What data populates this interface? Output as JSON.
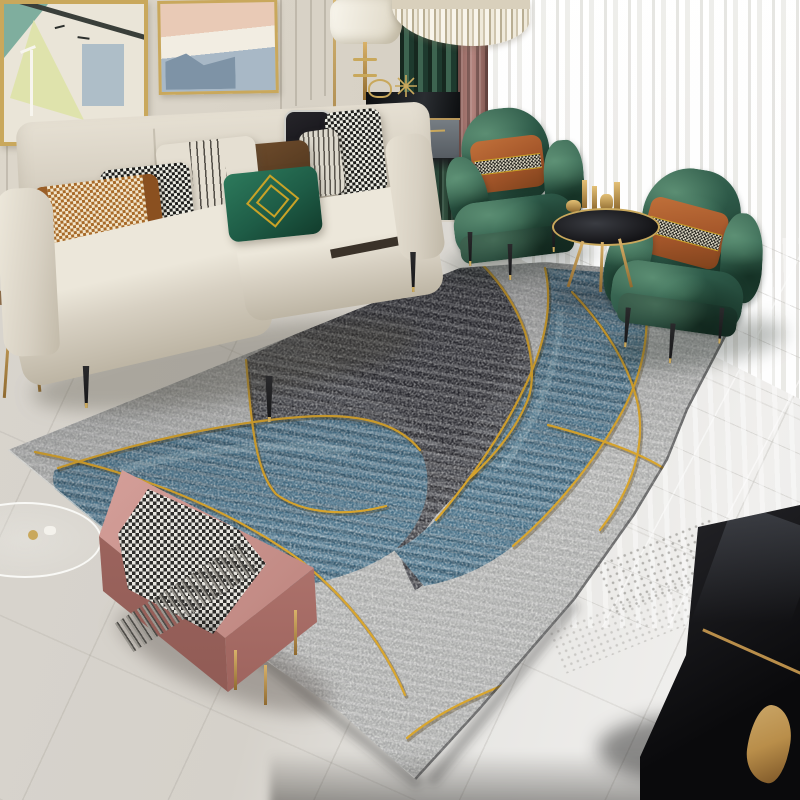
{
  "scene": {
    "type": "natural-image",
    "description": "Product photograph of a modern living room showcasing a large abstract area rug in mottled grey and charcoal with flowing blue bands outlined by thin gold lines. Beige fabric sofa with patterned pillows on the left, two emerald crushed-velvet armchairs with caramel houndstooth-band pillows on the right near sheer floor-to-ceiling curtains, pink velvet bench with grey houndstooth throw in the foreground, glossy marble floor, black coffee table with brass sculpture bottom-right.",
    "visible_text": ""
  },
  "palette": {
    "wall": "#d6d0c4",
    "wall-groove": "#bfb7a8",
    "frame-gold": "#c9a85c",
    "sheer": "#f2f1ef",
    "curtain-green": "#32503f",
    "curtain-mauve": "#b3847e",
    "sofa-cream": "#d7d0c2",
    "sofa-shadow": "#b6ae9d",
    "pillow-tan": "#a86a28",
    "pillow-brown": "#53381f",
    "pillow-green": "#1e5c46",
    "pillow-cream": "#e5dfd2",
    "pillow-gold": "#c9a227",
    "pillow-caramel": "#a4562a",
    "chair-green": "#2d5948",
    "chair-green-dark": "#1c3a2e",
    "chair-green-light": "#58876d",
    "bench-pink": "#c58e88",
    "bench-pink-dark": "#a16861",
    "blanket-dark": "#2e2d2b",
    "blanket-light": "#e8e6e0",
    "rug-light": "#b4b5b3",
    "rug-dark": "#43444a",
    "rug-black": "#222328",
    "rug-blue": "#47738c",
    "rug-blue-light": "#7ba3b5",
    "rug-gold": "#d9a62e",
    "floor-left": "#d8d4cd",
    "floor-right": "#f0efed",
    "table-black": "#141417",
    "brass": "#b98e4a",
    "leg-gold": "#c9a85c",
    "wood-dark": "#3c2f24"
  },
  "objects": {
    "list": [
      "framed-artwork-birds-lamppost",
      "framed-artwork-abstract-city",
      "panelled-wall",
      "crystal-chandelier",
      "floor-lamp",
      "black-sideboard-gold-ornaments",
      "green-curtain",
      "mauve-curtain",
      "sheer-curtains",
      "beige-sofa",
      "tan-weave-pillow",
      "houndstooth-brown-pillow",
      "cream-pinstripe-pillow",
      "brown-leather-pillow",
      "green-gold-diamond-pillow",
      "black-piped-pillow",
      "grey-pinstripe-pillow",
      "houndstooth-pillow",
      "emerald-velvet-armchair-left",
      "emerald-velvet-armchair-right",
      "caramel-houndstooth-pillows",
      "round-gold-side-table",
      "gold-vases",
      "abstract-area-rug-grey-blue-gold",
      "pink-velvet-bench",
      "houndstooth-throw-blanket",
      "marble-floor",
      "floor-vent",
      "glass-side-table",
      "wooden-console-table",
      "black-coffee-table",
      "brass-sculpture"
    ]
  }
}
